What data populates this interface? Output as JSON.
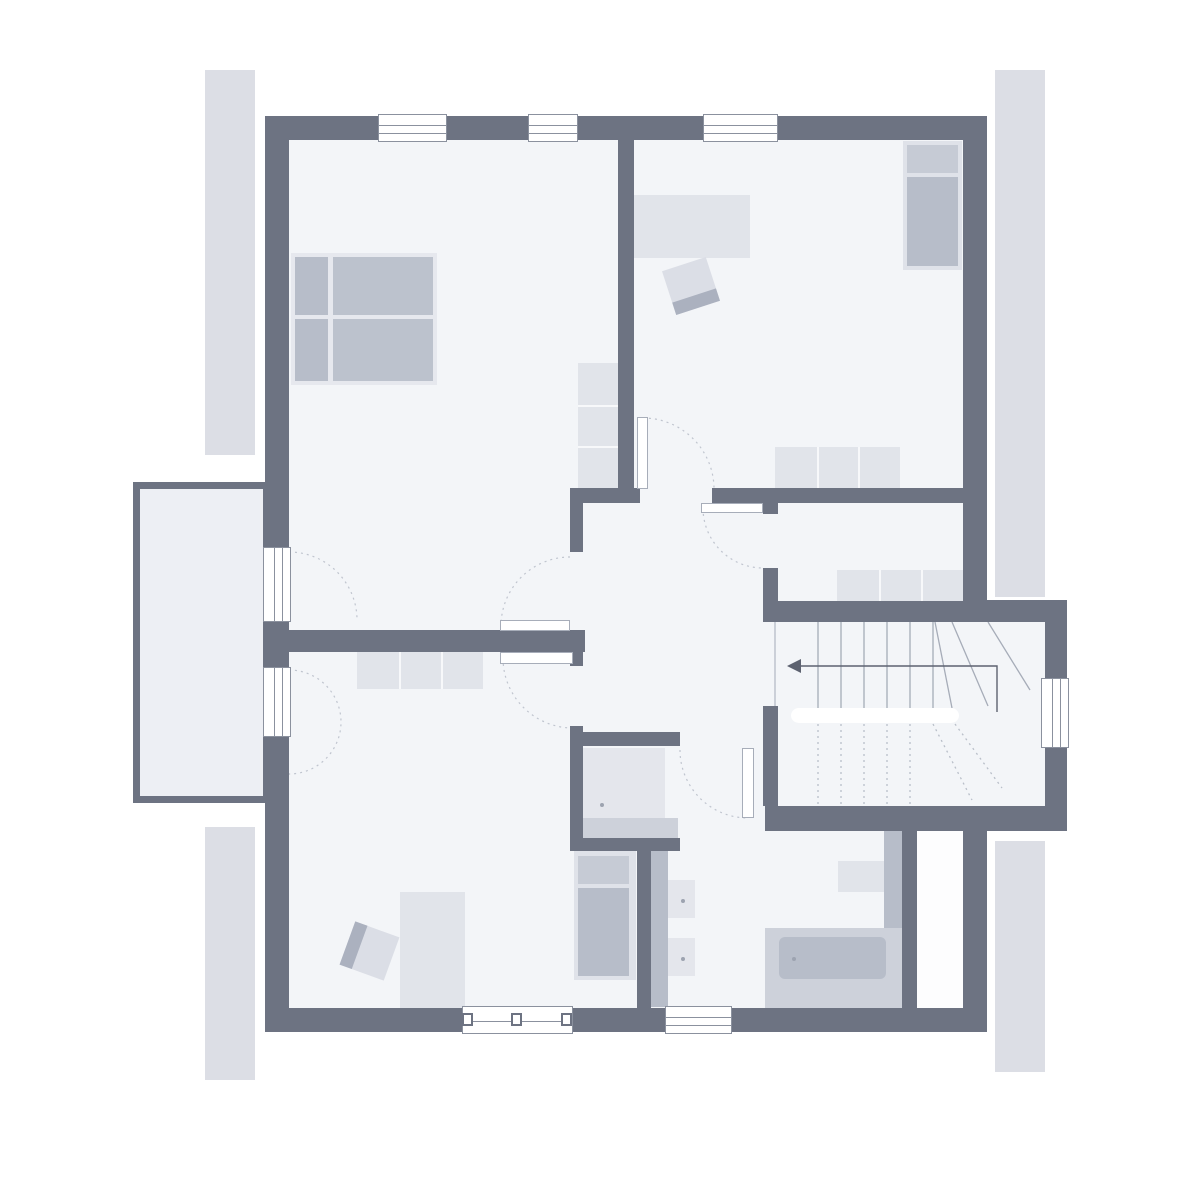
{
  "title": "floor-plan-upper-storey",
  "canvas": {
    "w": 1200,
    "h": 1200,
    "bg": "#ffffff"
  },
  "palette": {
    "wall": "#6d7382",
    "floor": "#f3f5f8",
    "balcony_floor": "#edeff4",
    "duct": "#fdfdfe",
    "roof_strip": "#dcdee5",
    "furn_light": "#e1e4ea",
    "furn_mid": "#b7bdc9",
    "furn_soft": "#cdd1da",
    "bed_base": "#e6e8ee",
    "pillow": "#c6cbd5",
    "frame": "#8b919e",
    "arc": "#c0c5cf",
    "stair_line": "#a6acb8",
    "arrow": "#5d6270",
    "dot": "#9da3b0",
    "white": "#ffffff"
  },
  "roof_strips": [
    {
      "name": "roof-edge-left-upper",
      "x": 205,
      "y": 70,
      "w": 50,
      "h": 385
    },
    {
      "name": "roof-edge-left-lower",
      "x": 205,
      "y": 827,
      "w": 50,
      "h": 253
    },
    {
      "name": "roof-edge-right-upper",
      "x": 995,
      "y": 70,
      "w": 50,
      "h": 527
    },
    {
      "name": "roof-edge-right-lower",
      "x": 995,
      "y": 841,
      "w": 50,
      "h": 231
    }
  ],
  "balcony": {
    "name": "balcony",
    "x": 133,
    "y": 482,
    "w": 137,
    "h": 321,
    "border": 7
  },
  "floors": [
    {
      "name": "floor-main",
      "x": 289,
      "y": 140,
      "w": 674,
      "h": 868,
      "fill": "#f3f5f8"
    },
    {
      "name": "floor-stairwell",
      "x": 963,
      "y": 622,
      "w": 82,
      "h": 184,
      "fill": "#f3f5f8"
    },
    {
      "name": "floor-duct",
      "x": 917,
      "y": 822,
      "w": 46,
      "h": 186,
      "fill": "#fdfdfe"
    }
  ],
  "walls": [
    {
      "name": "wall-outer-top",
      "x": 265,
      "y": 116,
      "w": 722,
      "h": 24
    },
    {
      "name": "wall-outer-left",
      "x": 265,
      "y": 116,
      "w": 24,
      "h": 916
    },
    {
      "name": "wall-outer-bottom",
      "x": 265,
      "y": 1008,
      "w": 722,
      "h": 24
    },
    {
      "name": "wall-outer-right-upper",
      "x": 963,
      "y": 116,
      "w": 24,
      "h": 497
    },
    {
      "name": "wall-outer-right-lower",
      "x": 963,
      "y": 810,
      "w": 24,
      "h": 222
    },
    {
      "name": "wall-stair-annex-top",
      "x": 963,
      "y": 600,
      "w": 104,
      "h": 22
    },
    {
      "name": "wall-stair-annex-right",
      "x": 1045,
      "y": 600,
      "w": 22,
      "h": 231
    },
    {
      "name": "wall-stair-annex-bottom",
      "x": 765,
      "y": 806,
      "w": 302,
      "h": 25
    },
    {
      "name": "wall-top-rooms-divider",
      "x": 618,
      "y": 140,
      "w": 16,
      "h": 350
    },
    {
      "name": "wall-hall-top-left",
      "x": 570,
      "y": 488,
      "w": 70,
      "h": 15
    },
    {
      "name": "wall-hall-top-right",
      "x": 712,
      "y": 488,
      "w": 251,
      "h": 15
    },
    {
      "name": "wall-storage-door-stub",
      "x": 763,
      "y": 503,
      "w": 15,
      "h": 11
    },
    {
      "name": "wall-hall-left-upper",
      "x": 570,
      "y": 503,
      "w": 13,
      "h": 49
    },
    {
      "name": "wall-mid-left",
      "x": 289,
      "y": 630,
      "w": 296,
      "h": 22
    },
    {
      "name": "wall-hall-left-mid",
      "x": 570,
      "y": 652,
      "w": 13,
      "h": 14
    },
    {
      "name": "wall-hall-left-lower",
      "x": 570,
      "y": 726,
      "w": 13,
      "h": 124
    },
    {
      "name": "wall-shower-top",
      "x": 570,
      "y": 732,
      "w": 110,
      "h": 14
    },
    {
      "name": "wall-shower-bottom",
      "x": 570,
      "y": 838,
      "w": 110,
      "h": 13
    },
    {
      "name": "wall-bath-left",
      "x": 637,
      "y": 851,
      "w": 14,
      "h": 157
    },
    {
      "name": "wall-storage-left",
      "x": 763,
      "y": 568,
      "w": 15,
      "h": 54
    },
    {
      "name": "wall-stair-top",
      "x": 763,
      "y": 601,
      "w": 222,
      "h": 21
    },
    {
      "name": "wall-stair-hall",
      "x": 763,
      "y": 706,
      "w": 15,
      "h": 100
    },
    {
      "name": "wall-bath-right",
      "x": 902,
      "y": 810,
      "w": 15,
      "h": 198
    }
  ],
  "furniture": {
    "rects": [
      {
        "name": "desk",
        "x": 633,
        "y": 195,
        "w": 117,
        "h": 63,
        "fill": "#e1e4ea"
      },
      {
        "name": "desk",
        "x": 400,
        "y": 892,
        "w": 65,
        "h": 116,
        "fill": "#e1e4ea"
      },
      {
        "name": "shower-tray",
        "x": 583,
        "y": 748,
        "w": 82,
        "h": 70,
        "fill": "#e4e6ec"
      },
      {
        "name": "shower-step",
        "x": 583,
        "y": 818,
        "w": 95,
        "h": 20,
        "fill": "#cdd1da"
      },
      {
        "name": "vanity-counter",
        "x": 651,
        "y": 851,
        "w": 17,
        "h": 156,
        "fill": "#b7bdc9"
      },
      {
        "name": "sink",
        "x": 668,
        "y": 880,
        "w": 27,
        "h": 38,
        "fill": "#e4e6ec"
      },
      {
        "name": "sink",
        "x": 668,
        "y": 938,
        "w": 27,
        "h": 38,
        "fill": "#e4e6ec"
      },
      {
        "name": "bathtub-deck",
        "x": 765,
        "y": 928,
        "w": 137,
        "h": 80,
        "fill": "#cdd1da"
      },
      {
        "name": "bathtub",
        "x": 779,
        "y": 937,
        "w": 107,
        "h": 42,
        "fill": "#b7bdc9",
        "r": 6
      },
      {
        "name": "toilet",
        "x": 838,
        "y": 861,
        "w": 46,
        "h": 31,
        "fill": "#e1e4ea"
      },
      {
        "name": "toilet-cistern",
        "x": 884,
        "y": 820,
        "w": 18,
        "h": 108,
        "fill": "#b7bdc9"
      }
    ],
    "beds": [
      {
        "name": "double-bed",
        "base": {
          "x": 291,
          "y": 253,
          "w": 146,
          "h": 132,
          "fill": "#e6e8ee"
        },
        "blocks": [
          {
            "x": 295,
            "y": 257,
            "w": 33,
            "h": 58,
            "fill": "#b7bdc9"
          },
          {
            "x": 295,
            "y": 319,
            "w": 33,
            "h": 62,
            "fill": "#b7bdc9"
          },
          {
            "x": 333,
            "y": 257,
            "w": 100,
            "h": 58,
            "fill": "#bcc2cd"
          },
          {
            "x": 333,
            "y": 319,
            "w": 100,
            "h": 62,
            "fill": "#bcc2cd"
          }
        ]
      },
      {
        "name": "single-bed",
        "base": {
          "x": 903,
          "y": 141,
          "w": 59,
          "h": 129,
          "fill": "#dfe2e9"
        },
        "blocks": [
          {
            "x": 907,
            "y": 145,
            "w": 51,
            "h": 28,
            "fill": "#c6cbd5"
          },
          {
            "x": 907,
            "y": 177,
            "w": 51,
            "h": 89,
            "fill": "#b7bdc9"
          }
        ]
      },
      {
        "name": "single-bed",
        "base": {
          "x": 574,
          "y": 851,
          "w": 62,
          "h": 129,
          "fill": "#dfe2e9"
        },
        "blocks": [
          {
            "x": 578,
            "y": 856,
            "w": 51,
            "h": 28,
            "fill": "#c6cbd5"
          },
          {
            "x": 578,
            "y": 888,
            "w": 51,
            "h": 88,
            "fill": "#b7bdc9"
          }
        ]
      }
    ],
    "chairs": [
      {
        "name": "desk-chair",
        "x": 668,
        "y": 263,
        "w": 46,
        "h": 46,
        "rotate": -18,
        "band": "bottom"
      },
      {
        "name": "desk-chair",
        "x": 346,
        "y": 928,
        "w": 47,
        "h": 46,
        "rotate": 20,
        "band": "left"
      }
    ],
    "cabinets": [
      {
        "name": "wardrobe",
        "x": 578,
        "y": 363,
        "w": 42,
        "h": 125,
        "sections": 3,
        "dir": "y",
        "fill": "#e1e4ea"
      },
      {
        "name": "sideboard",
        "x": 775,
        "y": 447,
        "w": 125,
        "h": 42,
        "sections": 3,
        "dir": "x",
        "fill": "#e1e4ea"
      },
      {
        "name": "sideboard",
        "x": 837,
        "y": 570,
        "w": 126,
        "h": 42,
        "sections": 3,
        "dir": "x",
        "fill": "#e1e4ea"
      },
      {
        "name": "dresser",
        "x": 357,
        "y": 649,
        "w": 126,
        "h": 40,
        "sections": 3,
        "dir": "x",
        "fill": "#e1e4ea"
      }
    ],
    "dots": [
      {
        "name": "shower-drain",
        "x": 600,
        "y": 803
      },
      {
        "name": "sink-drain",
        "x": 681,
        "y": 899
      },
      {
        "name": "sink-drain",
        "x": 681,
        "y": 957
      },
      {
        "name": "bathtub-drain",
        "x": 792,
        "y": 957
      }
    ]
  },
  "windows": {
    "horizontal": [
      {
        "name": "window-top-1",
        "x": 378,
        "y": 114,
        "w": 69,
        "h": 28
      },
      {
        "name": "window-top-2",
        "x": 528,
        "y": 114,
        "w": 50,
        "h": 28
      },
      {
        "name": "window-top-3",
        "x": 703,
        "y": 114,
        "w": 75,
        "h": 28
      },
      {
        "name": "window-bath",
        "x": 665,
        "y": 1006,
        "w": 67,
        "h": 28
      }
    ],
    "vertical": [
      {
        "name": "balcony-door-upper",
        "x": 263,
        "y": 547,
        "w": 28,
        "h": 75
      },
      {
        "name": "balcony-door-lower",
        "x": 263,
        "y": 667,
        "w": 28,
        "h": 70
      },
      {
        "name": "window-stairwell",
        "x": 1041,
        "y": 678,
        "w": 28,
        "h": 70
      }
    ],
    "wide": {
      "name": "window-bottom-wide",
      "x": 462,
      "y": 1006,
      "w": 111,
      "h": 28,
      "posts": [
        462,
        511,
        561
      ],
      "post_w": 11,
      "post_h": 13
    }
  },
  "doors": {
    "leaves": [
      {
        "name": "door-leaf-top-right-room",
        "x": 637,
        "y": 417,
        "w": 11,
        "h": 72
      },
      {
        "name": "door-leaf-storage-room",
        "x": 701,
        "y": 503,
        "w": 62,
        "h": 10
      },
      {
        "name": "door-leaf-top-left-room",
        "x": 500,
        "y": 620,
        "w": 70,
        "h": 11
      },
      {
        "name": "door-leaf-bottom-left-room",
        "x": 500,
        "y": 652,
        "w": 73,
        "h": 12
      },
      {
        "name": "door-leaf-bathroom",
        "x": 742,
        "y": 748,
        "w": 12,
        "h": 70
      }
    ],
    "arcs": [
      {
        "name": "door-arc-top-right-room",
        "d": "M 643 418 A 71 71 0 0 1 714 489"
      },
      {
        "name": "door-arc-storage-room",
        "d": "M 703 508 A 60 60 0 0 0 763 568"
      },
      {
        "name": "door-arc-top-left-room",
        "d": "M 570 557 A 69 69 0 0 0 501 626"
      },
      {
        "name": "door-arc-bottom-left-room",
        "d": "M 503 658 A 70 70 0 0 0 573 728"
      },
      {
        "name": "door-arc-bathroom",
        "d": "M 680 750 A 68 68 0 0 0 748 818"
      },
      {
        "name": "door-arc-balcony-upper",
        "d": "M 289 552 A 68 68 0 0 1 357 620"
      },
      {
        "name": "door-arc-balcony-lower",
        "d": "M 289 670 A 52 52 0 0 1 289 774"
      }
    ]
  },
  "stairs": {
    "edge_line": [
      775,
      622,
      775,
      806
    ],
    "upper_treads": {
      "xs": [
        818,
        841,
        864,
        887,
        910,
        933
      ],
      "y1": 622,
      "y2": 708
    },
    "upper_diagonals": [
      [
        935,
        622,
        952,
        708
      ],
      [
        952,
        622,
        988,
        706
      ],
      [
        988,
        622,
        1030,
        690
      ]
    ],
    "lower_treads": {
      "xs": [
        818,
        841,
        864,
        887,
        910
      ],
      "y1": 724,
      "y2": 804
    },
    "lower_diagonals": [
      [
        933,
        724,
        972,
        800
      ],
      [
        955,
        724,
        1002,
        788
      ]
    ],
    "rail": {
      "x": 791,
      "y": 708,
      "w": 168,
      "h": 15,
      "r": 8
    },
    "arrow": {
      "points": [
        [
          997,
          712
        ],
        [
          997,
          666
        ],
        [
          801,
          666
        ]
      ],
      "head": [
        [
          787,
          666
        ],
        [
          801,
          659
        ],
        [
          801,
          673
        ]
      ]
    }
  }
}
